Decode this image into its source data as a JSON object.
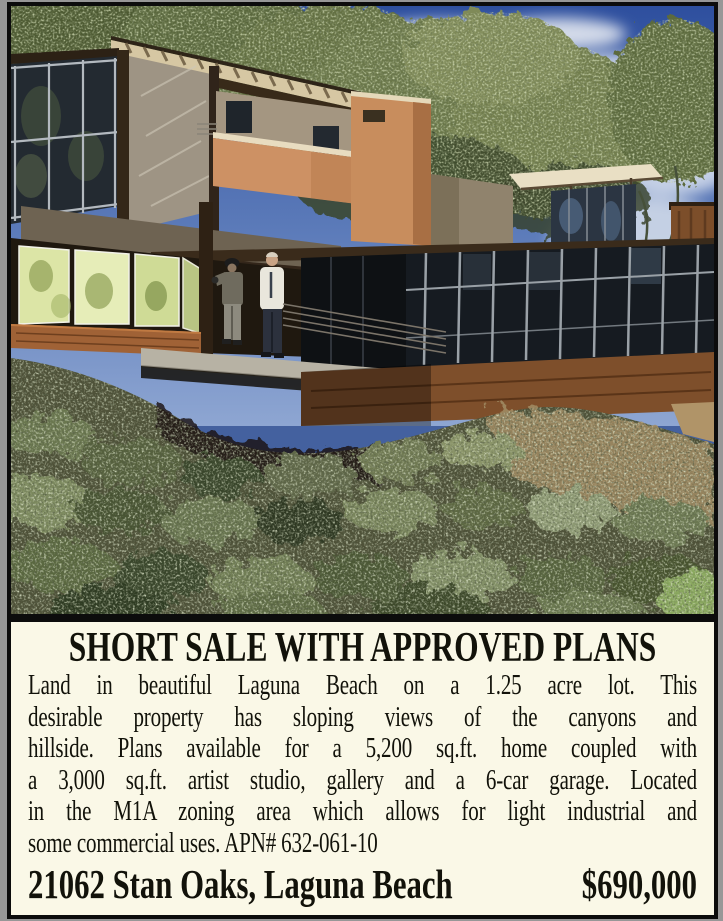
{
  "ad": {
    "headline": "SHORT SALE WITH APPROVED PLANS",
    "body_lines": [
      "Land in beautiful Laguna Beach on a 1.25 acre lot. This",
      "desirable property has sloping views of the canyons and",
      "hillside. Plans available for a 5,200 sq.ft. home coupled with",
      "a 3,000 sq.ft. artist studio, gallery and a 6-car garage. Located",
      "in the M1A zoning area which allows for light industrial and",
      "some commercial uses. APN# 632-061-10"
    ],
    "address": "21062 Stan Oaks, Laguna Beach",
    "price": "$690,000",
    "photo_description": "Rendering of a modern cantilevered hillside home above canyon scrub, two people standing on the walkway",
    "colors": {
      "panel_background": "#faf8e7",
      "frame_black": "#0c0c0c",
      "surround_gray": "#979797",
      "terracotta_accent": "#cd9164",
      "sky_blue": "#33549b"
    }
  }
}
